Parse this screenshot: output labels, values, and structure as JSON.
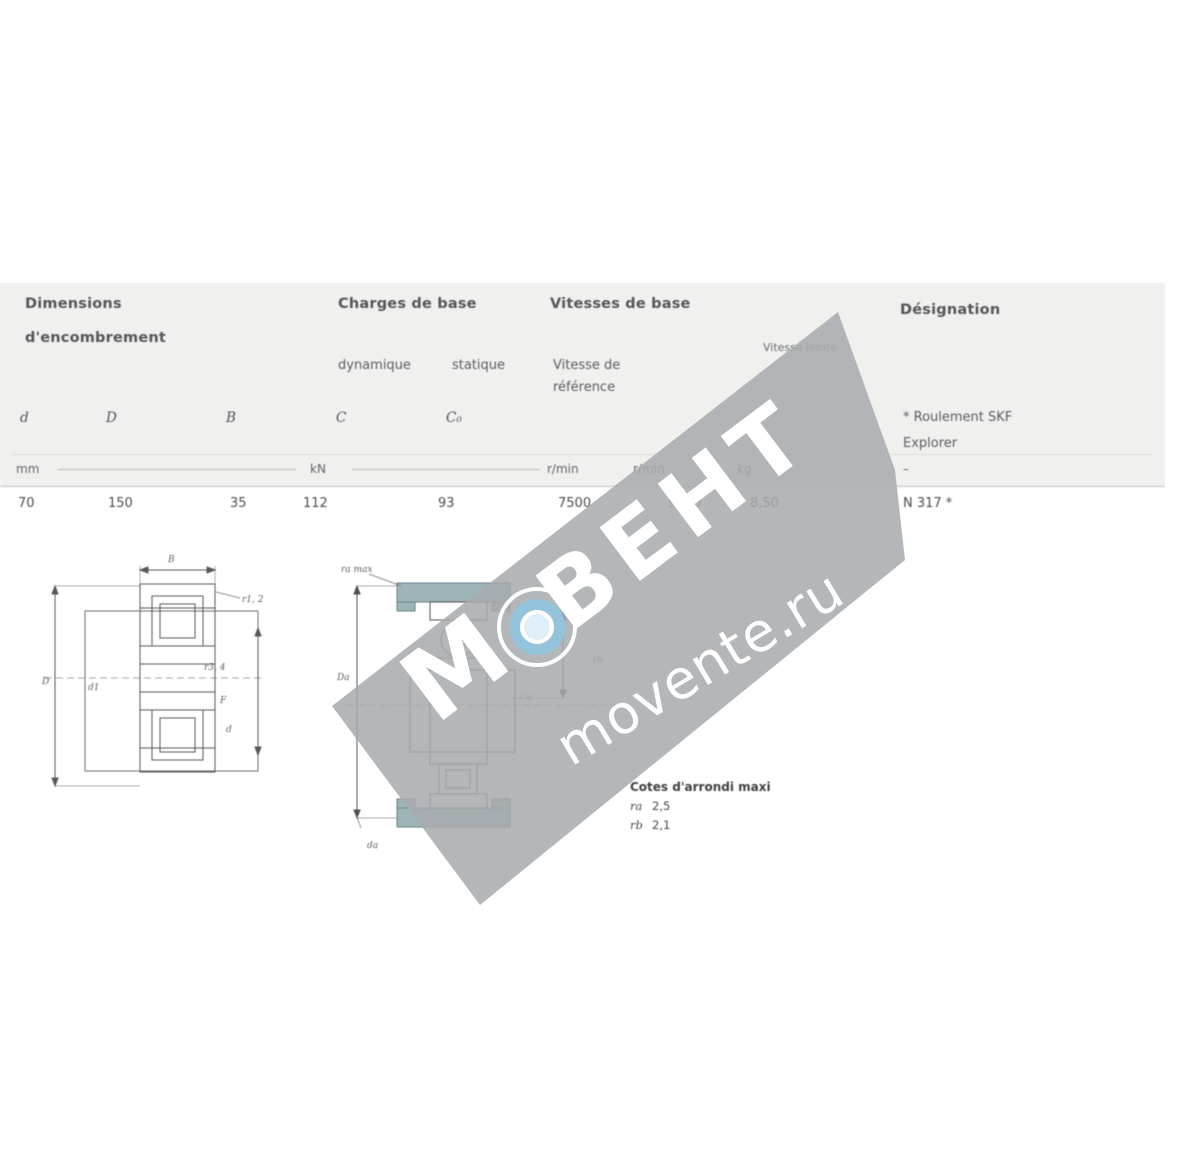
{
  "page": {
    "bg": "#ffffff",
    "band_bg": "#f0f0ee",
    "line_color": "#c9c9c7",
    "drawing_line_color": "#505356",
    "housing_fill": "#9eb5b8"
  },
  "table": {
    "col1_header_line1": "Dimensions",
    "col1_header_line2": "d'encombrement",
    "col2_header": "Charges de base",
    "col3_header": "Vitesses de base",
    "col4_header": "Désignation",
    "sub_dynamique": "dynamique",
    "sub_statique": "statique",
    "sub_vref_line1": "Vitesse de",
    "sub_vref_line2": "référence",
    "sub_vlim": "Vitesse limite",
    "sym_d": "d",
    "sym_D": "D",
    "sym_B": "B",
    "sym_C": "C",
    "sym_C0": "C₀",
    "explorer_line1": "* Roulement SKF",
    "explorer_line2": "Explorer",
    "unit_mm": "mm",
    "unit_kn": "kN",
    "unit_rmin1": "r/min",
    "unit_rmin2": "r/min",
    "unit_kg": "kg",
    "unit_dash": "–",
    "row": {
      "d": "70",
      "D": "150",
      "B": "35",
      "C": "112",
      "C0": "93",
      "v_ref": "7500",
      "v_lim": "9000",
      "mass": "8,50",
      "designation": "N 317 *"
    }
  },
  "drawing_left": {
    "label_B": "B",
    "label_r12": "r1, 2",
    "label_D": "D",
    "label_d1": "d1",
    "label_F": "F",
    "label_d": "d",
    "label_r34": "r3, 4"
  },
  "drawing_mid": {
    "label_ra": "ra max",
    "label_Da": "Da",
    "label_rb": "rb",
    "label_Ca": "Ca",
    "label_da": "da"
  },
  "notes": {
    "heading": "Cotes d'arrondi maxi",
    "line1_sym": "ra",
    "line1_val": "2,5",
    "line2_sym": "rb",
    "line2_val": "2,1"
  },
  "watermark": {
    "brand": "ВЕНТ",
    "url": "movente.ru",
    "letter": "М",
    "band_color": "rgba(167,170,173,0.85)",
    "ring_color": "#93c4dc",
    "ring_inner_color": "#dfeff7",
    "text_color": "#ffffff"
  }
}
